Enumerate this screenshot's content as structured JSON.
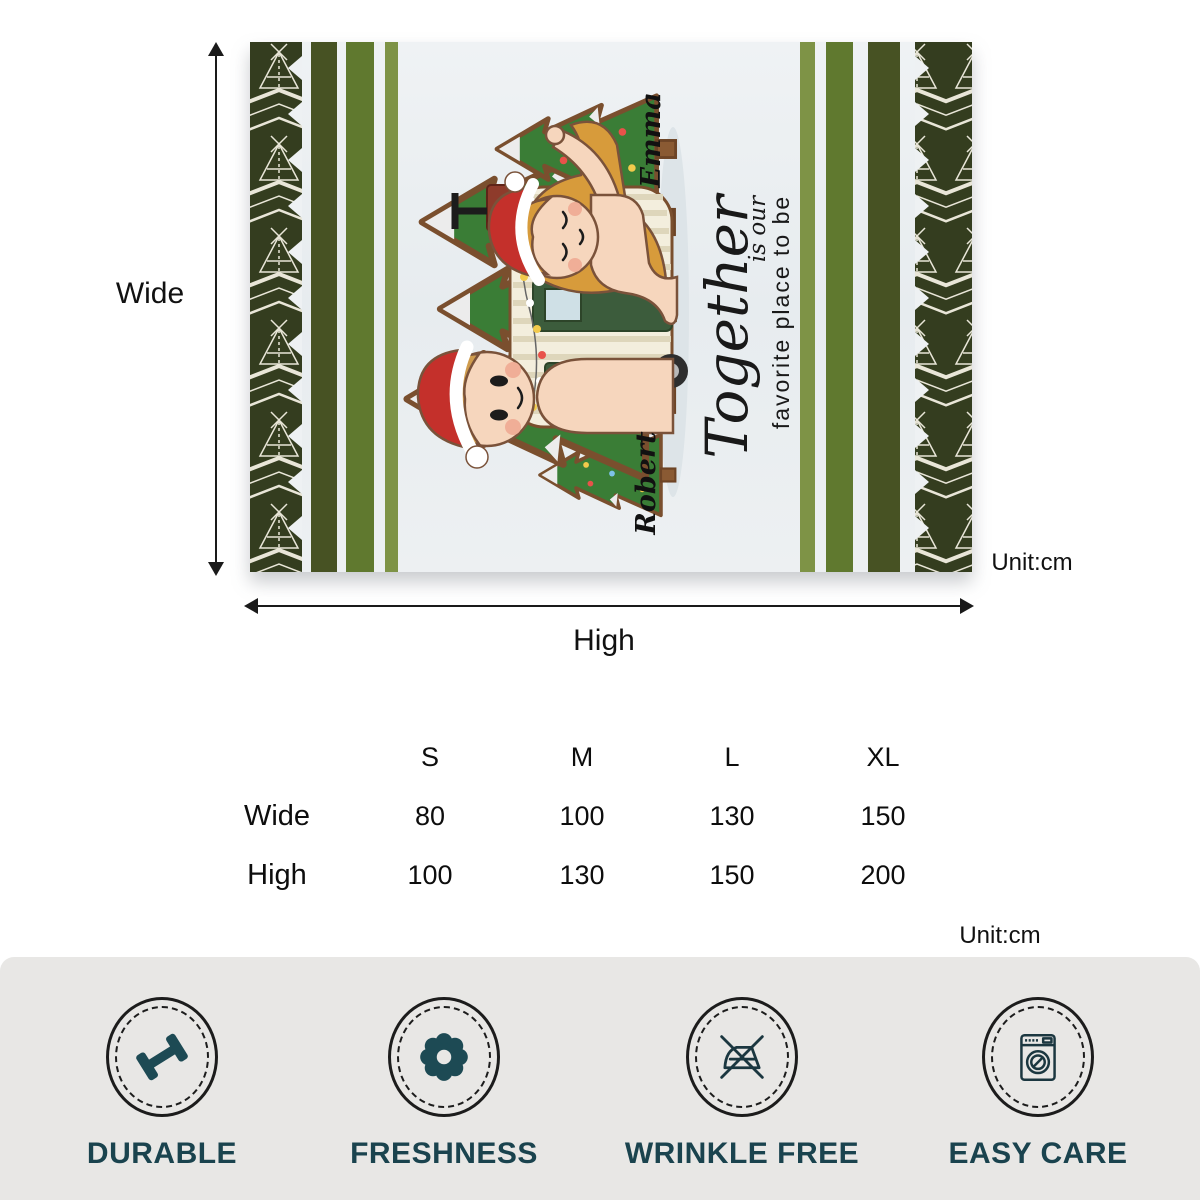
{
  "blanket": {
    "names": {
      "top": "Emma",
      "bottom": "Robert"
    },
    "quote": {
      "line1": "Together",
      "line2": "is our",
      "line3": "favorite place to be"
    },
    "theme": "christmas-camper-couple",
    "colors": {
      "tribal_border": "#343d1f",
      "stripe_dark": "#475223",
      "stripe_medium": "#60792f",
      "stripe_light": "#7e9346",
      "field": "#e9edf1",
      "santa_red": "#c4302b",
      "tree_green": "#3a7d36",
      "camper_cream": "#f3eedd"
    }
  },
  "dimensions": {
    "wide_label": "Wide",
    "high_label": "High",
    "unit_label": "Unit:cm"
  },
  "size_table": {
    "columns": [
      "S",
      "M",
      "L",
      "XL"
    ],
    "rows": [
      {
        "label": "Wide",
        "values": [
          "80",
          "100",
          "130",
          "150"
        ]
      },
      {
        "label": "High",
        "values": [
          "100",
          "130",
          "150",
          "200"
        ]
      }
    ],
    "unit_label": "Unit:cm"
  },
  "features": [
    {
      "label": "DURABLE",
      "icon": "dumbbell-icon",
      "color": "#1d4a54"
    },
    {
      "label": "FRESHNESS",
      "icon": "flower-icon",
      "color": "#1d4a54"
    },
    {
      "label": "WRINKLE FREE",
      "icon": "no-iron-icon",
      "color": "#1b3740"
    },
    {
      "label": "EASY CARE",
      "icon": "washing-machine-icon",
      "color": "#1b3740"
    }
  ]
}
